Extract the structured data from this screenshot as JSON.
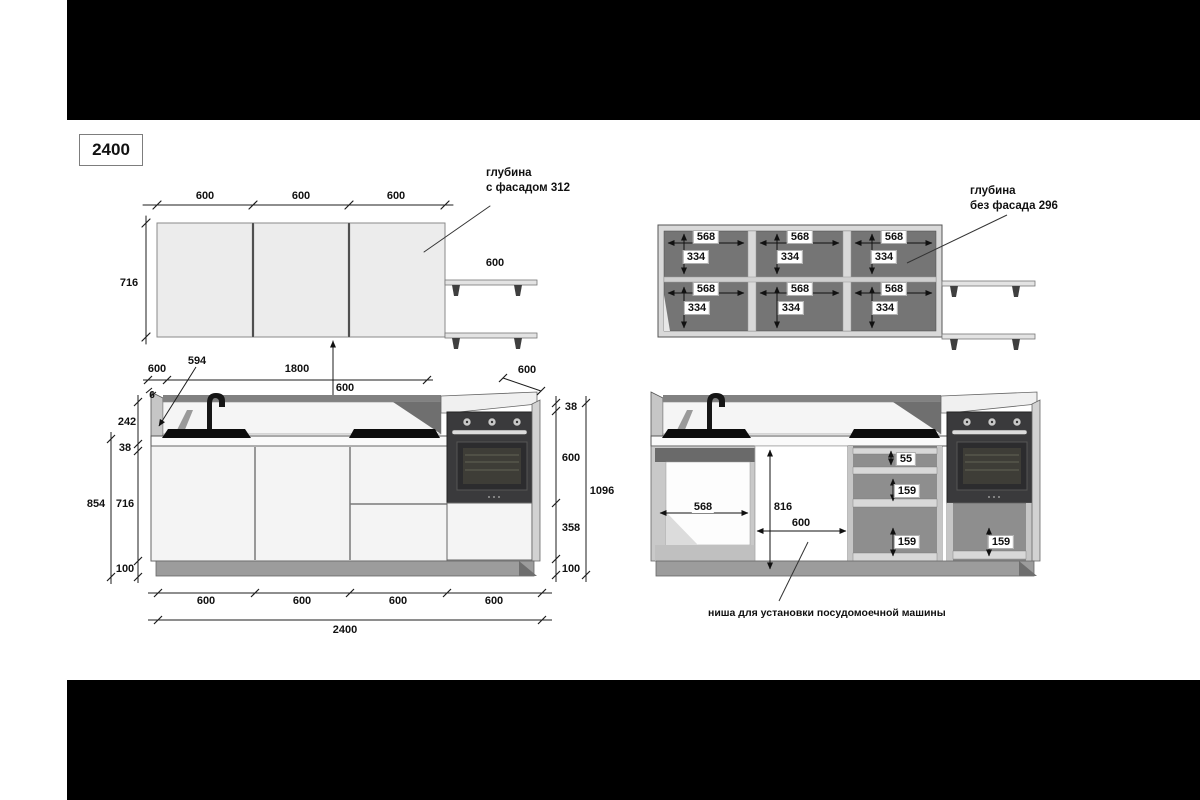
{
  "layout_title": "2400",
  "notes": {
    "facade_depth_line1": "глубина",
    "facade_depth_line2": "с фасадом 312",
    "no_facade_depth_line1": "глубина",
    "no_facade_depth_line2": "без фасада 296",
    "dishwasher_caption": "ниша для установки посудомоечной машины"
  },
  "upper_front": {
    "door_widths": [
      "600",
      "600",
      "600"
    ],
    "cabinet_height": "716",
    "shelf_width": "600"
  },
  "between": {
    "upper_to_counter": "600"
  },
  "upper_open": {
    "inner_width": "568",
    "inner_height": "334"
  },
  "lower_front": {
    "top": {
      "depth": "600",
      "side_panel": "594",
      "panel_thickness": "6",
      "run_width": "1800",
      "right_depth": "600"
    },
    "left": {
      "backsplash": "242",
      "counter": "38",
      "base_total": "854",
      "carcass": "716",
      "plinth": "100"
    },
    "right": {
      "counter": "38",
      "oven": "600",
      "drawer": "358",
      "plinth": "100",
      "total": "1096"
    },
    "bottom": {
      "modules": [
        "600",
        "600",
        "600",
        "600"
      ],
      "total": "2400"
    }
  },
  "lower_open": {
    "sink_inner_width": "568",
    "niche_height": "816",
    "niche_width": "600",
    "drawer_heights": [
      "55",
      "159",
      "159"
    ],
    "oven_drawer_height": "159"
  }
}
